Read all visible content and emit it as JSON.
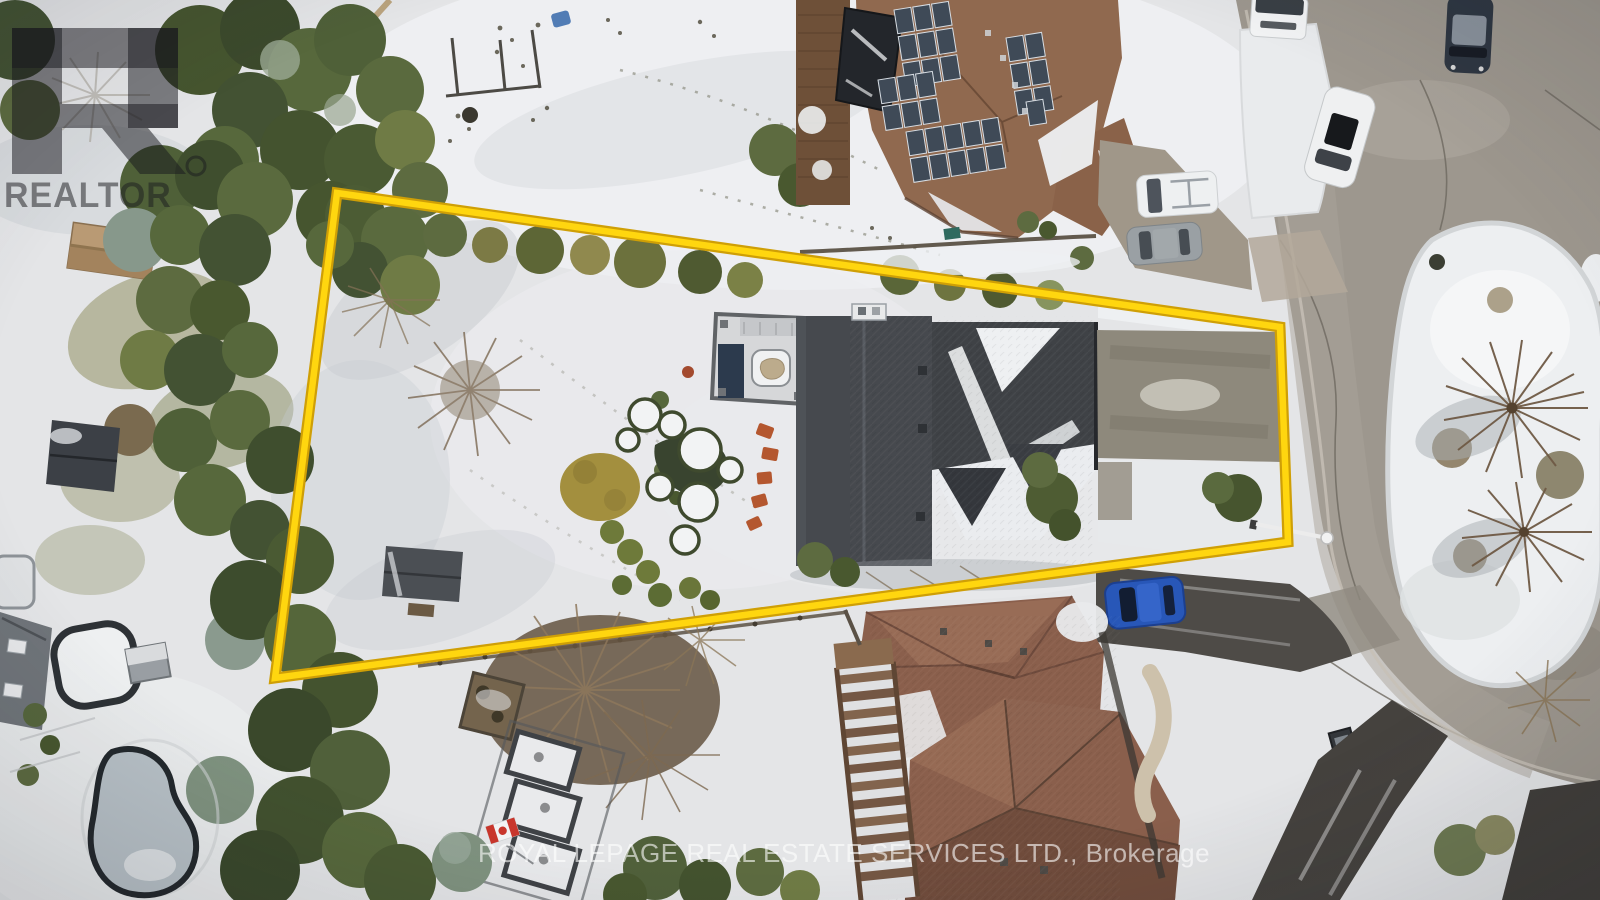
{
  "photo": {
    "type": "aerial drone photograph",
    "season": "winter",
    "subject": "snow-covered residential lot with highlighted property boundary on a cul-de-sac"
  },
  "watermarks": {
    "realtor_logo_text": "REALTOR",
    "registered_mark": "®",
    "brokerage_line": "ROYAL LEPAGE REAL ESTATE SERVICES LTD., Brokerage"
  },
  "boundary": {
    "points": "337,193 1280,327 1288,542 275,678",
    "color_main": "#ffd60f",
    "color_edge": "#cf9f06"
  },
  "palette": {
    "snow": "#e4e5e7",
    "road_asphalt": "#9d978e",
    "driveway_concrete": "#8e897c",
    "driveway_dark_asphalt": "#4e4b47",
    "roof_main_house": "#46494e",
    "roof_top_house": "#90694f",
    "roof_bottom_house": "#8a5f4c",
    "solar_panel": "#3f4a57",
    "evergreen": "#435233",
    "pool_ice": "#b7c0c6",
    "car_blue": "#2857b8"
  }
}
